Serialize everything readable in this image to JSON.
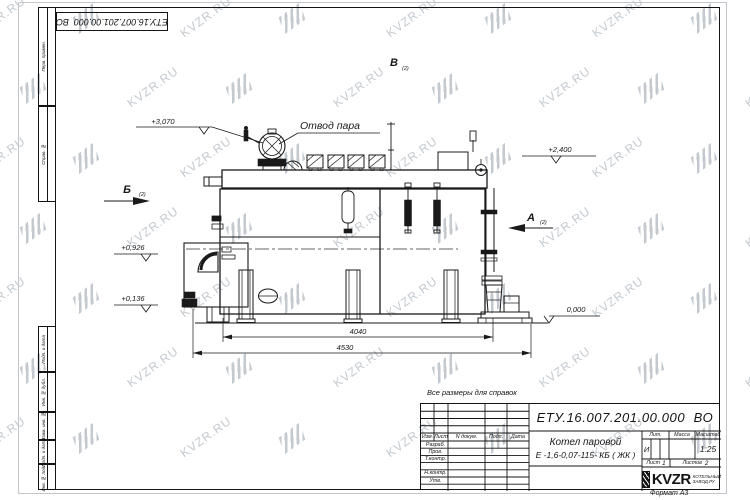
{
  "page": {
    "format_note": "Формат А3",
    "reference_note": "Все размеры для справок"
  },
  "document": {
    "code": "ЕТУ.16.007.201.00.000  ВО",
    "name_line1": "Котел паровой",
    "name_line2": "Е -1,6-0,07-115- КБ ( ЖК )"
  },
  "watermark": {
    "text": "KVZR.RU"
  },
  "margin_labels": [
    "Перв. примен.",
    "Справ. №",
    "Подп. и дата",
    "Инв. № дубл.",
    "Взам. инв. №",
    "Подп. и дата",
    "Инв. № подл."
  ],
  "stamp": {
    "header_cols": [
      "Изм.",
      "Лист",
      "N докум.",
      "Подп.",
      "Дата"
    ],
    "sign_rows": [
      "Разраб.",
      "Пров.",
      "Т.контр.",
      "Н.контр.",
      "Утв."
    ],
    "lit_label": "Лит.",
    "mass_label": "Масса",
    "scale_label": "Масштаб",
    "lit_value": "И",
    "scale_value": "1:25",
    "sheet_label": "Лист",
    "sheet_value": "1",
    "sheets_label": "Листов",
    "sheets_value": "2",
    "logo_text": "KVZR",
    "logo_sub1": "КОТЕЛЬНЫЙ",
    "logo_sub2": "ЗАВОД.РУ"
  },
  "drawing": {
    "steam_label": "Отвод пара",
    "views": {
      "a": "А",
      "b": "Б",
      "v": "В",
      "ref": "(2)"
    },
    "elevations": {
      "top": "+3,070",
      "drum": "+2,400",
      "axis": "+0,926",
      "low": "+0,136",
      "zero": "0,000"
    },
    "dims": {
      "inner": "4040",
      "overall": "4530"
    }
  }
}
